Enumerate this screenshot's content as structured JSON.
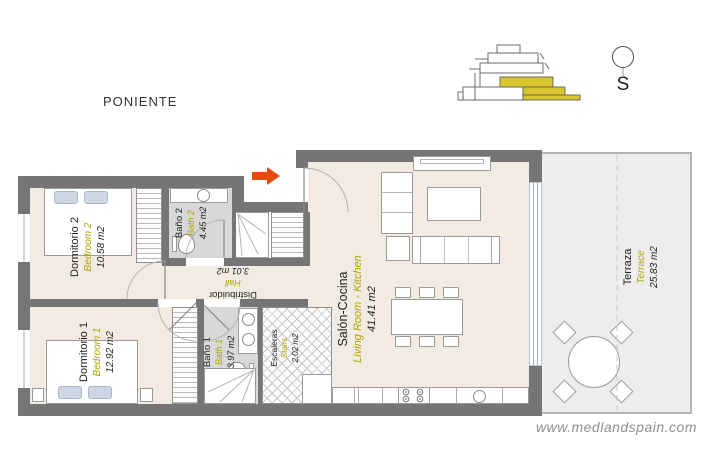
{
  "header": {
    "zone_label": "PONIENTE"
  },
  "compass": {
    "letter": "S"
  },
  "watermark": {
    "text": "www.medlandspain.com"
  },
  "building_icon": {
    "name": "building-section",
    "highlight_color": "#d9c62e"
  },
  "entry_arrow": {
    "color": "#e8490f",
    "direction": "right"
  },
  "colors": {
    "wall": "#757575",
    "room_floor": "#f1ebe2",
    "bath_floor": "#d8d8d8",
    "terrace_floor": "#ededec",
    "accent_yellow": "#b3a400"
  },
  "rooms": [
    {
      "id": "bedroom2",
      "name_es": "Dormitorio 2",
      "name_en": "Bedroom 2",
      "area": "10.58 m2"
    },
    {
      "id": "bath2",
      "name_es": "Baño 2",
      "name_en": "Bath 2",
      "area": "4.45 m2"
    },
    {
      "id": "hall",
      "name_es": "Distribuidor",
      "name_en": "Hall",
      "area": "3.01 m2"
    },
    {
      "id": "bedroom1",
      "name_es": "Dormitorio 1",
      "name_en": "Bedroom 1",
      "area": "12.92 m2"
    },
    {
      "id": "bath1",
      "name_es": "Baño 1",
      "name_en": "Bath 1",
      "area": "3.97 m2"
    },
    {
      "id": "stairs",
      "name_es": "Escaleras",
      "name_en": "Stairs",
      "area": "2.02 m2"
    },
    {
      "id": "living",
      "name_es": "Salón-Cocina",
      "name_en": "Living Room - Kitchen",
      "area": "41.41 m2"
    },
    {
      "id": "terrace",
      "name_es": "Terraza",
      "name_en": "Terrace",
      "area": "25.83 m2"
    }
  ]
}
